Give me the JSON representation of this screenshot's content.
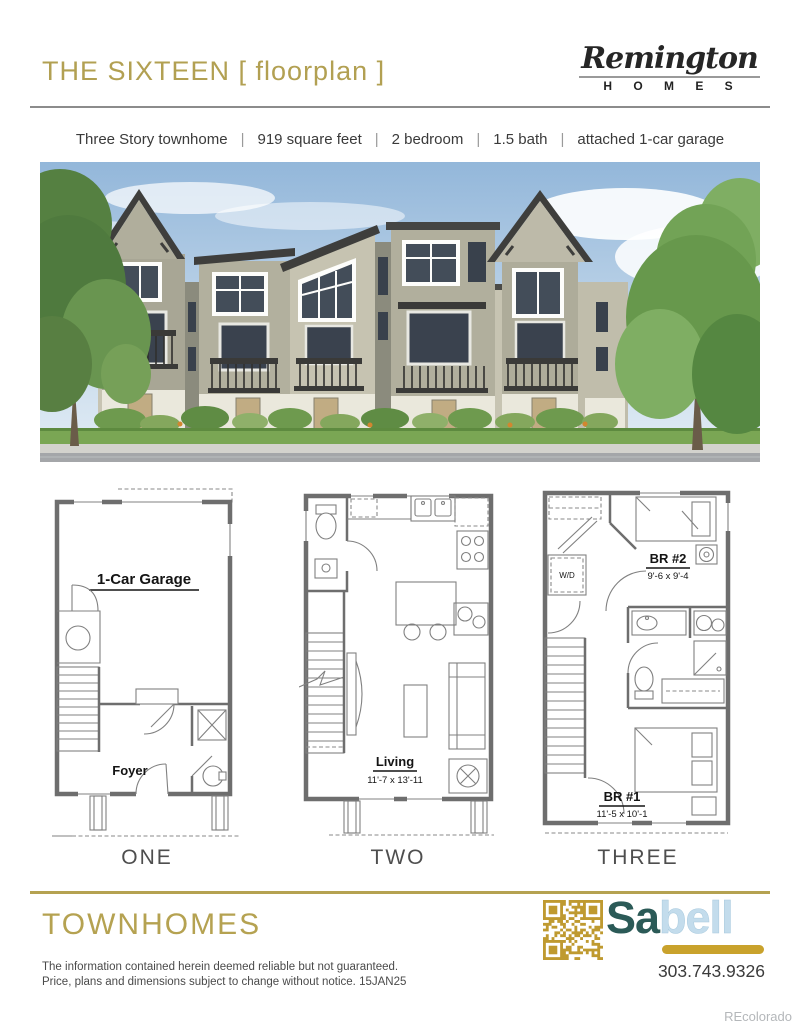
{
  "header": {
    "title": "THE SIXTEEN [ floorplan ]",
    "logo_script": "Remington",
    "logo_sub": "H O M E S"
  },
  "specs": {
    "sep": "|",
    "items": [
      "Three Story townhome",
      "919 square feet",
      "2 bedroom",
      "1.5 bath",
      "attached 1-car garage"
    ]
  },
  "plans": {
    "one": {
      "label": "ONE",
      "garage": "1-Car Garage",
      "foyer": "Foyer"
    },
    "two": {
      "label": "TWO",
      "living": "Living",
      "living_dims": "11'-7 x 13'-11"
    },
    "three": {
      "label": "THREE",
      "wd": "W/D",
      "br2": "BR #2",
      "br2_dims": "9'-6 x 9'-4",
      "br1": "BR #1",
      "br1_dims": "11'-5 x 10'-1"
    }
  },
  "footer": {
    "community": "TOWNHOMES",
    "disclaimer1": "The information contained herein deemed reliable but not guaranteed.",
    "disclaimer2": "Price, plans and dimensions subject to change without notice. 15JAN25",
    "brand_a": "Sa",
    "brand_b": "bell",
    "phone": "303.743.9326",
    "watermark": "REcolorado"
  },
  "colors": {
    "gold": "#b2a052",
    "qr_gold": "#bf9a30",
    "teal": "#2b5a57",
    "light_blue": "#c3dcec",
    "rule_gray": "#8c8c8c",
    "text_dark": "#3a3a3a"
  }
}
